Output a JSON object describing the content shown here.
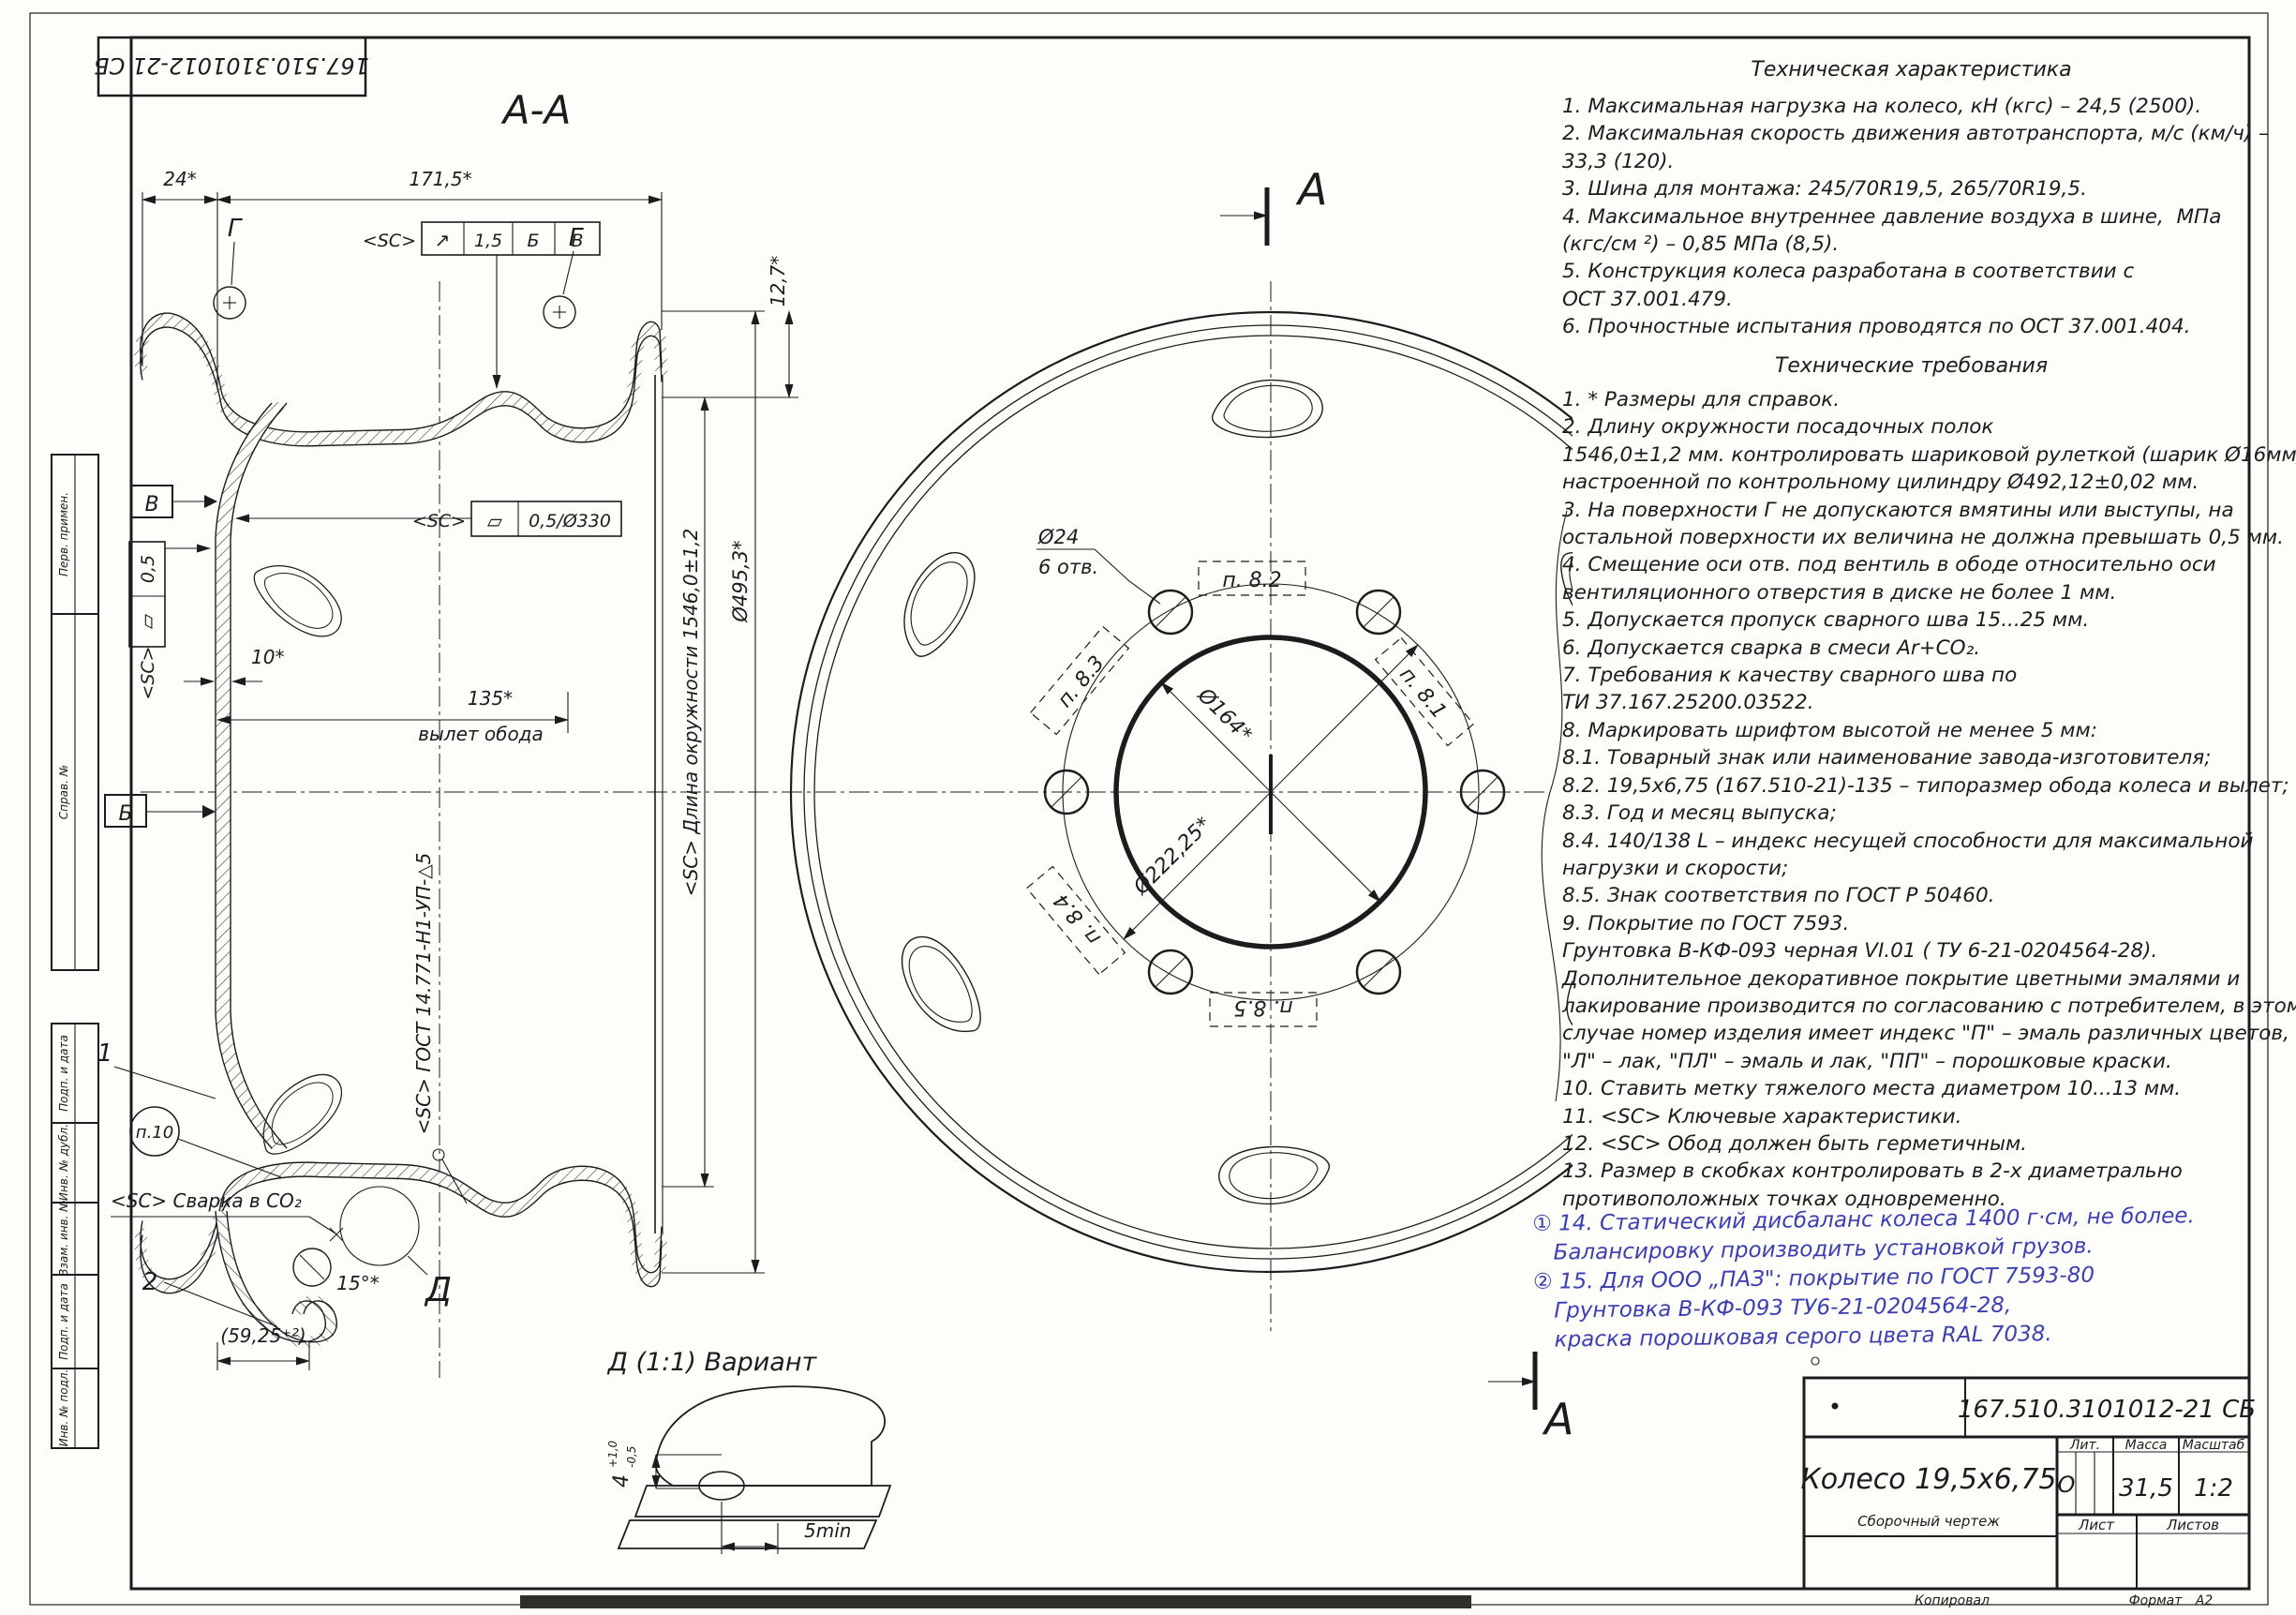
{
  "corner_stamp": "167.510.3101012-21 СБ",
  "margin_labels": [
    "Перв. примен.",
    "Справ. №",
    "Подп. и дата",
    "Инв. № дубл.",
    "Взам. инв. №",
    "Подп. и дата",
    "Инв. № подл."
  ],
  "tech_characteristics": {
    "title": "Техническая характеристика",
    "lines": [
      "1. Максимальная нагрузка на колесо, кН (кгс) – 24,5 (2500).",
      "2. Максимальная скорость движения автотранспорта, м/с (км/ч) –",
      "33,3 (120).",
      "3. Шина для монтажа: 245/70R19,5, 265/70R19,5.",
      "4. Максимальное внутреннее давление воздуха в шине,  МПа",
      "(кгс/см ²) – 0,85 МПа (8,5).",
      "5. Конструкция колеса разработана в соответствии с",
      "ОСТ 37.001.479.",
      "6. Прочностные испытания проводятся по ОСТ 37.001.404."
    ]
  },
  "tech_requirements": {
    "title": "Технические требования",
    "lines": [
      "1. * Размеры для справок.",
      "2. Длину окружности посадочных полок",
      "1546,0±1,2 мм. контролировать шариковой рулеткой (шарик Ø16мм)",
      "настроенной по контрольному цилиндру Ø492,12±0,02 мм.",
      "3. На поверхности Г не допускаются вмятины или выступы, на",
      "остальной поверхности их величина не должна превышать 0,5 мм.",
      "4. Смещение оси отв. под вентиль в ободе относительно оси",
      "вентиляционного отверстия в диске не более 1 мм.",
      "5. Допускается пропуск сварного шва 15...25 мм.",
      "6. Допускается сварка в смеси Ar+CO₂.",
      "7. Требования к качеству сварного шва по",
      "ТИ 37.167.25200.03522.",
      "8. Маркировать шрифтом высотой не менее 5 мм:",
      "8.1. Товарный знак или наименование завода-изготовителя;",
      "8.2. 19,5х6,75 (167.510-21)-135 – типоразмер обода колеса и вылет;",
      "8.3. Год и месяц выпуска;",
      "8.4. 140/138 L – индекс несущей способности для максимальной",
      "нагрузки и скорости;",
      "8.5. Знак соответствия по ГОСТ Р 50460.",
      "9. Покрытие по ГОСТ 7593.",
      "Грунтовка В-КФ-093 черная VI.01 ( ТУ 6-21-0204564-28).",
      "Дополнительное декоративное покрытие цветными эмалями и",
      "лакирование производится по согласованию с потребителем, в этом",
      "случае номер изделия имеет индекс \"П\" – эмаль различных цветов,",
      "\"Л\" – лак, \"ПЛ\" – эмаль и лак, \"ПП\" – порошковые краски.",
      "10. Ставить метку тяжелого места диаметром 10...13 мм.",
      "11. <SC> Ключевые характеристики.",
      "12. <SC> Обод должен быть герметичным.",
      "13. Размер в скобках контролировать в 2-х диаметрально",
      "противоположных точках одновременно."
    ]
  },
  "handwritten_notes": {
    "color": "#3c3fb2",
    "lines": [
      "① 14. Статический дисбаланс колеса 1400 г·см, не более.",
      "   Балансировку производить установкой грузов.",
      "② 15. Для ООО „ПАЗ\": покрытие по ГОСТ 7593-80",
      "   Грунтовка В-КФ-093 ТУ6-21-0204564-28,",
      "   краска порошковая серого цвета RAL 7038."
    ]
  },
  "section_view": {
    "title": "А-А",
    "dim_24": "24*",
    "dim_171_5": "171,5*",
    "fcf_sc": "<SC>",
    "fcf_sym": "↗",
    "fcf_val": "1,5",
    "fcf_d1": "Б",
    "fcf_d2": "В",
    "g_left": "Г",
    "g_right": "Г",
    "dim_12_7": "12,7*",
    "dim_d495": "Ø495,3*",
    "circumference_note": "<SC> Длина окружности 1546,0±1,2",
    "datum_v": "В",
    "datum_b": "Б",
    "fcf2_val": "0,5",
    "fcf2_sym": "▱",
    "fcf2_sc": "<SC>",
    "dim_10": "10*",
    "dim_135": "135*",
    "dim_135_label": "вылет обода",
    "fcf3_sc": "<SC>",
    "fcf3_sym": "▱",
    "fcf3_val": "0,5/Ø330",
    "weld_note": "<SC>  ГОСТ 14.771-Н1-УП-△5",
    "pos_1": "1",
    "pos_2": "2",
    "p10": "п.10",
    "weld_co2": "<SC> Сварка в CO₂",
    "dim_15deg": "15°*",
    "detail_mark": "Д",
    "dim_59_25": "(59,25⁺²)"
  },
  "front_view": {
    "hole_dia": "Ø24",
    "hole_count": "6 отв.",
    "p_8_1": "п. 8.1",
    "p_8_2": "п. 8.2",
    "p_8_3": "п. 8.3",
    "p_8_4": "п. 8.4",
    "p_8_5": "п. 8.5",
    "dim_d164": "Ø164*",
    "dim_d222": "Ø222,25*",
    "mark_a_top": "А",
    "mark_a_bottom": "А"
  },
  "detail_view": {
    "title": "Д (1:1) Вариант",
    "dim4_base": "4",
    "dim4_sup": "+1,0",
    "dim4_sub": "-0,5",
    "dim_5min": "5min"
  },
  "title_block": {
    "doc_number": "167.510.3101012-21 СБ",
    "part_name": "Колесо 19,5х6,75",
    "doc_subtitle": "Сборочный чертеж",
    "lit_header": "Лит.",
    "mass_header": "Масса",
    "scale_header": "Масштаб",
    "lit_value": "О",
    "mass_value": "31,5",
    "scale_value": "1:2",
    "sheet_header": "Лист",
    "sheets_header": "Листов",
    "copied_label": "Копировал",
    "format_label": "Формат",
    "format_value": "А2"
  }
}
